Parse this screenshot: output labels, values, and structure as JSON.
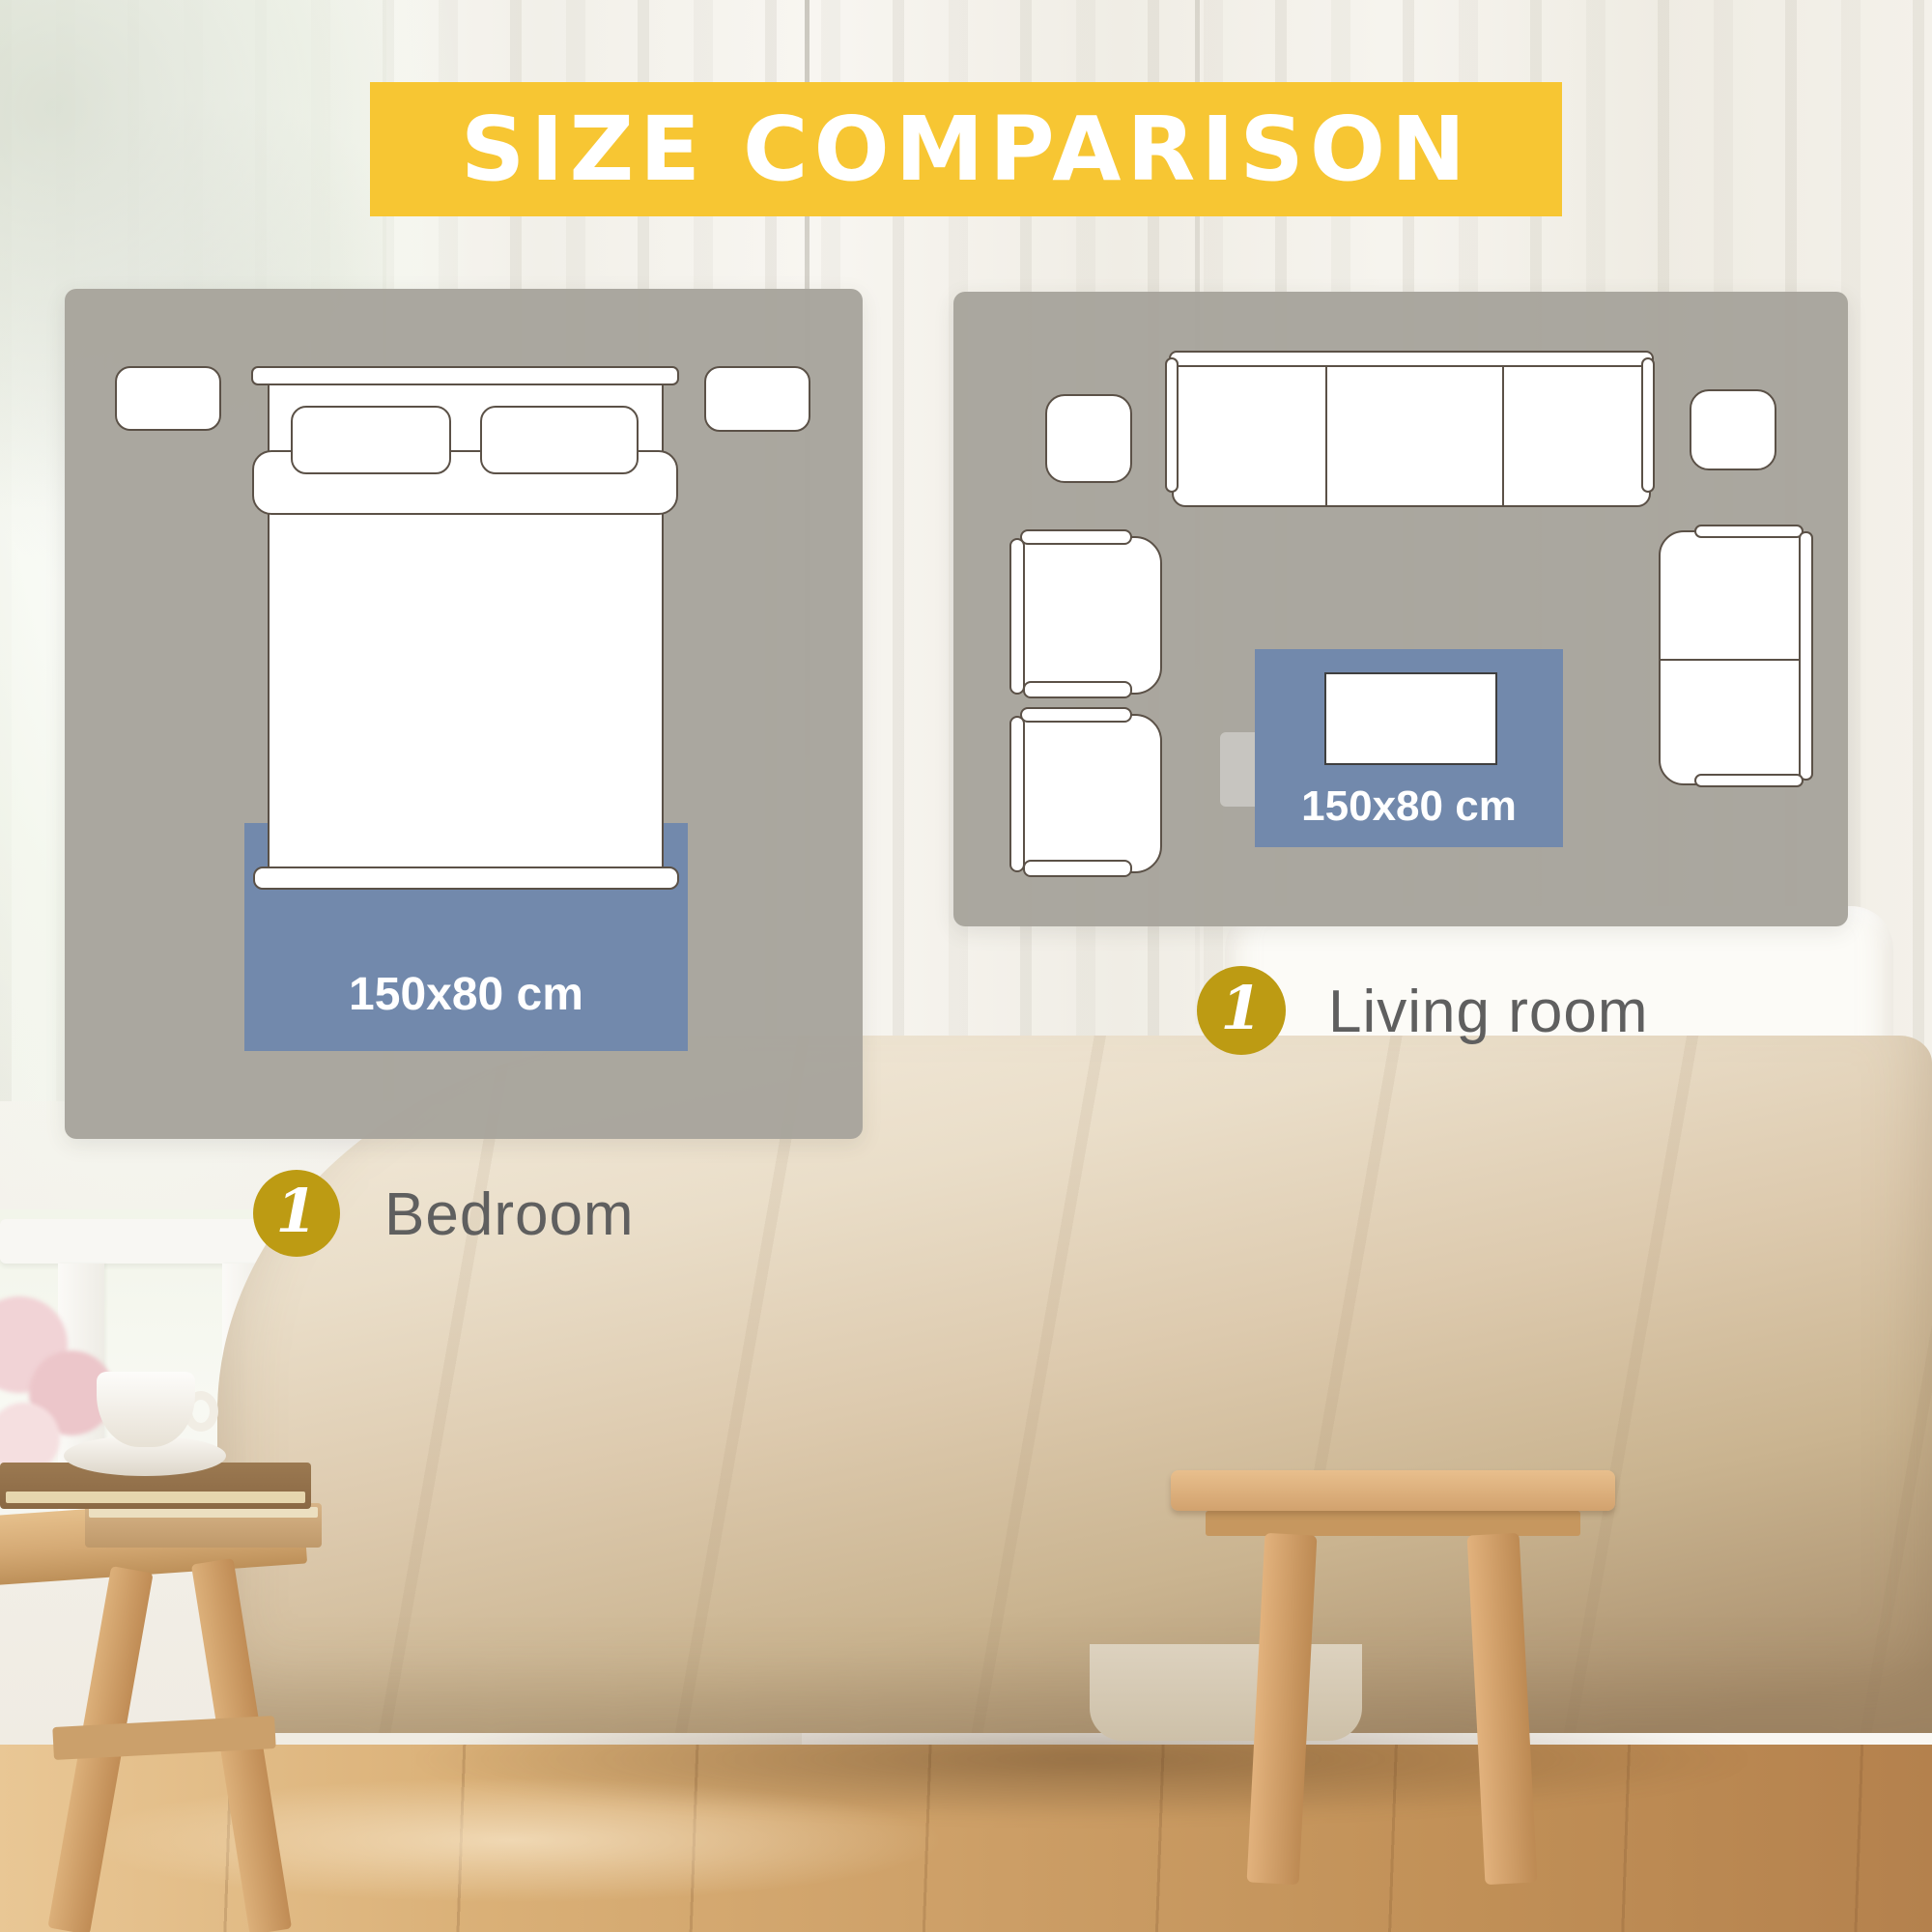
{
  "banner": {
    "text": "SIZE COMPARISON",
    "bg": "#F7C633",
    "text_color": "#FFFFFF"
  },
  "comparison_panels": [
    {
      "id": "bedroom",
      "badge": "1",
      "room_label": "Bedroom",
      "rug_label": "150x80 cm",
      "furniture": [
        "nightstand-left",
        "nightstand-right",
        "double-bed",
        "pillow-left",
        "pillow-right",
        "rug"
      ]
    },
    {
      "id": "living_room",
      "badge": "1",
      "room_label": "Living room",
      "rug_label": "150x80 cm",
      "furniture": [
        "sofa",
        "side-table-left",
        "side-table-right",
        "armchair-top",
        "armchair-bottom",
        "loveseat",
        "coffee-table",
        "tv-console",
        "rug"
      ]
    }
  ],
  "colors": {
    "banner_yellow": "#F7C633",
    "badge_gold": "#BD9B13",
    "rug_blue": "#7289AC",
    "panel_gray": "#A7A49C",
    "furniture_outline": "#5B5147",
    "label_text": "#5F5F5F"
  }
}
